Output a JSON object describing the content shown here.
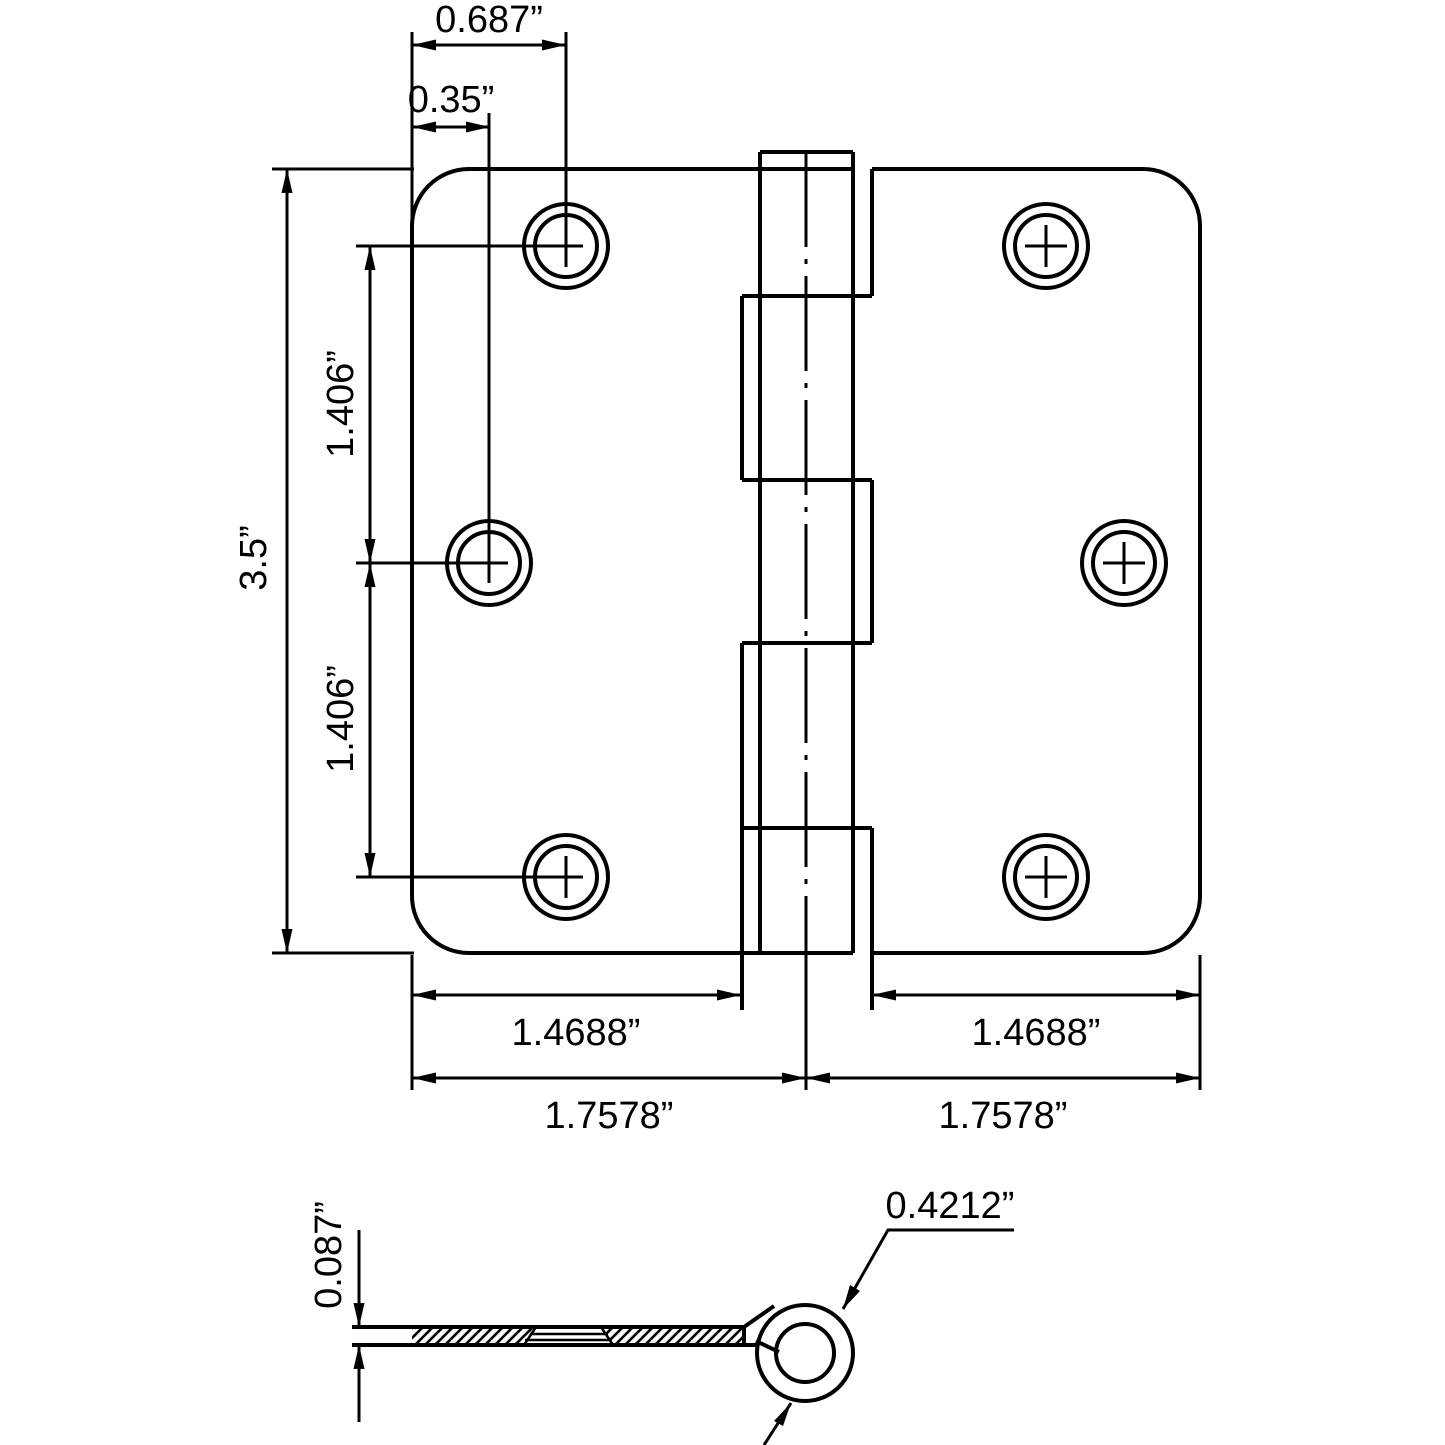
{
  "page": {
    "background": "#ffffff",
    "line_color": "#000000",
    "content": "technical dimension drawing of a 3.5 inch door hinge, top view and edge cross-section view"
  },
  "top_view": {
    "dims": {
      "top_hole_offset": "0.687”",
      "mid_hole_offset": "0.35”",
      "height": "3.5”",
      "upper_hole_spacing": "1.406”",
      "lower_hole_spacing": "1.406”",
      "left_screw_area_width": "1.4688”",
      "right_screw_area_width": "1.4688”",
      "left_leaf_width": "1.7578”",
      "right_leaf_width": "1.7578”"
    }
  },
  "side_view": {
    "dims": {
      "leaf_thickness": "0.087”",
      "knuckle_diameter": "0.4212”"
    }
  }
}
